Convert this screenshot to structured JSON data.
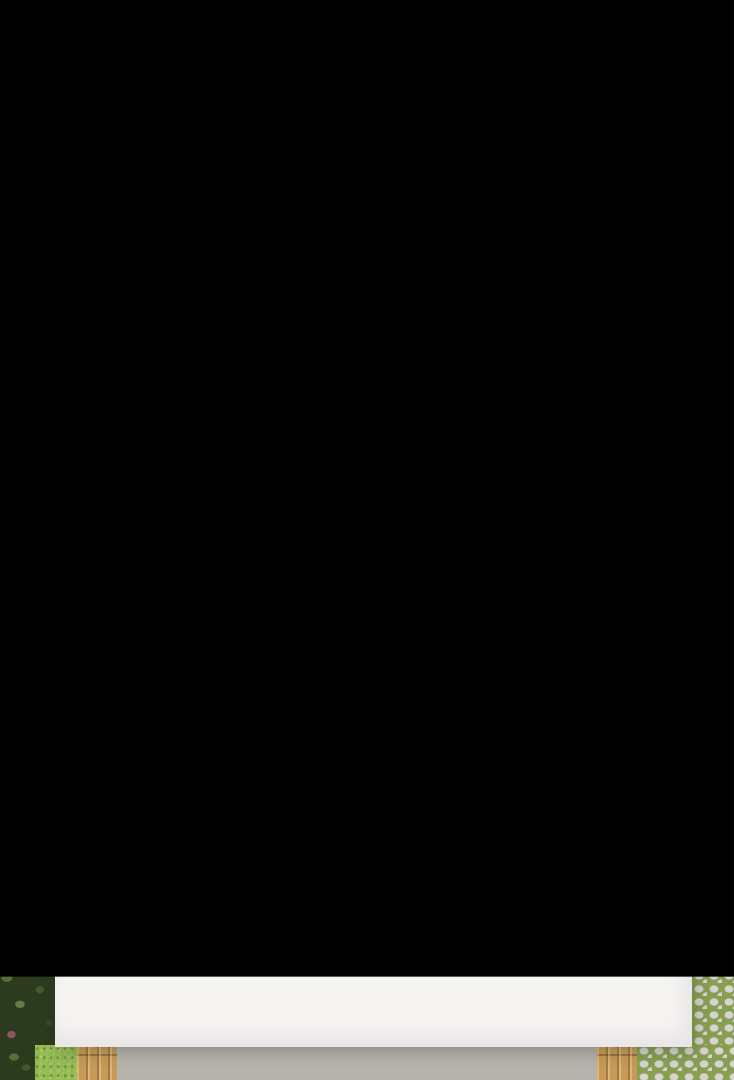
{
  "meta": {
    "description": "Top-down 3D render of a small rectangular house floor plan with two bedrooms, bathroom, WC, utility room, hallway, entry and open-plan kitchen/living/dining room, surrounded by hedges, lawn and a cobblestone path",
    "canvas": {
      "width": 734,
      "height": 1080
    },
    "visible_text": "Lo"
  },
  "entry": {
    "front_door_mark": "Lo"
  },
  "palette": {
    "vegetation": "#2c3a1d",
    "grass_top": "#5e8d3c",
    "grass_right": "#93ba52",
    "cobble_stone": "#d7d5cd",
    "cobble_grout": "#87a04f",
    "concrete": "#b6b3ad",
    "deck_wood": "#c89a58",
    "house_white": "#f7f5f3",
    "wall_shadow": "#c2c6cd",
    "wood_floor_left": "#9a5528",
    "wood_floor_right": "#8a4220",
    "wood_accent": "#c48d52",
    "dresser_brown": "#44301f",
    "duvet_teal": "#2d5d70",
    "duvet_yellow": "#f0c41d",
    "bed_orange": "#e0521e",
    "rug_sage": "#6d7a68",
    "rug_floral_base": "#cfc3a8",
    "tile_light": "#d8d4cd",
    "counter_dark": "#3a3a3c",
    "cooktop_black": "#1e1e20",
    "cabinet_orange": "#f2a35c",
    "mint_glass": "#cfe8e2",
    "sink_dark": "#232325",
    "appliance_gray": "#9d9b98",
    "fixture_gray": "#b4b2ae",
    "boiler_white": "#e9e7e3",
    "shower_gray": "#cdcbc7",
    "door_dark": "#323234",
    "sofa_dark": "#3a3a3d",
    "seat_dark": "#28282c",
    "table_dark": "#37373a",
    "chair_black": "#1c1c1e",
    "rug_c1": "#2e6a66",
    "rug_c2": "#e8e4d4",
    "rug_c3": "#c9a227",
    "rug_c4": "#20503f",
    "rug_c5": "#7d8d90",
    "coffee_wood": "#96663e",
    "console_gray": "#c6c4c0",
    "tv_black": "#141416",
    "tv_screen": "#d2a41f",
    "window_frame": "#2b2b2d",
    "glass_gray": "#b7c2c4"
  },
  "rooms": [
    {
      "name": "bedroom-left",
      "floor": "wood",
      "furniture": [
        "double-bed",
        "teal-floral-duvet",
        "two-pillows",
        "nightstand",
        "nightstand",
        "sage-rug",
        "low-dresser",
        "skylight-window",
        "side-window"
      ]
    },
    {
      "name": "bedroom-right",
      "floor": "wood",
      "furniture": [
        "double-bed",
        "yellow-floral-duvet",
        "two-pillows",
        "orange-headboard",
        "floral-runner-rug",
        "low-dresser",
        "skylight-window"
      ]
    },
    {
      "name": "wc",
      "floor": "tile",
      "furniture": [
        "toilet",
        "wall-vent"
      ]
    },
    {
      "name": "utility-room",
      "floor": "tile",
      "furniture": [
        "boiler-cylinder",
        "storage-box",
        "wall-shelf"
      ]
    },
    {
      "name": "hallway",
      "floor": "tile",
      "furniture": [
        "open-door-slabs"
      ]
    },
    {
      "name": "bathroom",
      "floor": "tile",
      "furniture": [
        "vanity-sink",
        "shower-tray",
        "side-window"
      ]
    },
    {
      "name": "entry",
      "floor": "tile",
      "furniture": [
        "front-door"
      ]
    },
    {
      "name": "kitchen-living",
      "floor": "tile",
      "furniture": [
        "l-shaped-counter",
        "cooktop",
        "small-appliance",
        "orange-cabinet",
        "mint-glass-fronts",
        "sink",
        "dining-table",
        "four-chairs",
        "plant-vase",
        "armchair",
        "sofa",
        "triangle-pattern-rug",
        "coffee-table",
        "tv-console",
        "wall-tv",
        "picture-window",
        "sliding-glass-door"
      ]
    }
  ],
  "surroundings": [
    "hedge-strip-left",
    "lawn-top",
    "lawn-right",
    "cobblestone-path-right",
    "concrete-patio-bottom",
    "wood-deck-strips"
  ]
}
